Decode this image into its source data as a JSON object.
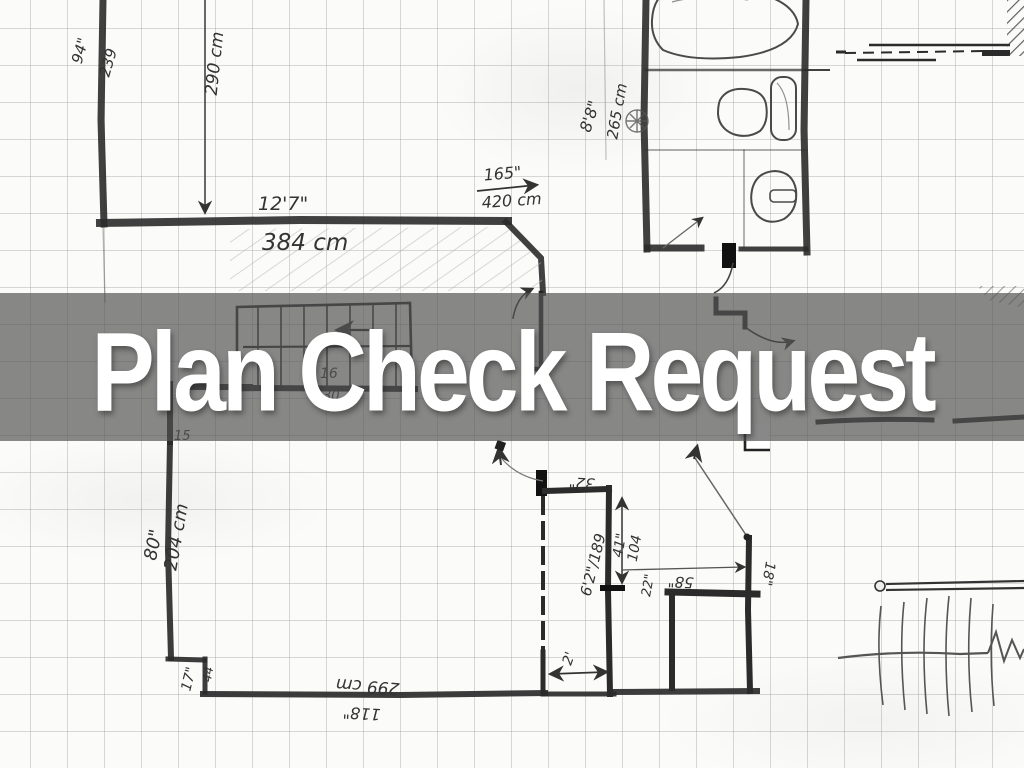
{
  "slide": {
    "title": "Plan Check Request",
    "banner_color": "rgba(85,85,85,0.70)",
    "title_color": "#ffffff",
    "pencil_color": "#2b2b2b"
  },
  "floorplan": {
    "upper_left_room": {
      "wall_height_in": "94\"",
      "wall_height_cm": "239",
      "inner_height_cm": "290 cm",
      "width_ft": "12'7\"",
      "width_cm": "384 cm"
    },
    "entry": {
      "span_in": "165\"",
      "span_cm": "420 cm"
    },
    "bathroom": {
      "height_ft": "8'8\"",
      "height_cm": "265 cm"
    },
    "lower_left_room": {
      "height_in": "80\"",
      "height_cm": "204 cm",
      "step_in": "17\"",
      "step_cm": "44",
      "width_cm": "299 cm",
      "width_in": "118\""
    },
    "closet": {
      "top_in": "32\"",
      "side_ft_cm": "6'2\"/189",
      "depth_in": "41\"",
      "depth_cm": "104",
      "gap_in": "22\"",
      "door_ft": "2'"
    },
    "landing": {
      "width_in": "58\"",
      "wall_in": "18\""
    },
    "stair_notes": {
      "note_a": "16",
      "note_b": "30",
      "note_c": "15"
    }
  }
}
